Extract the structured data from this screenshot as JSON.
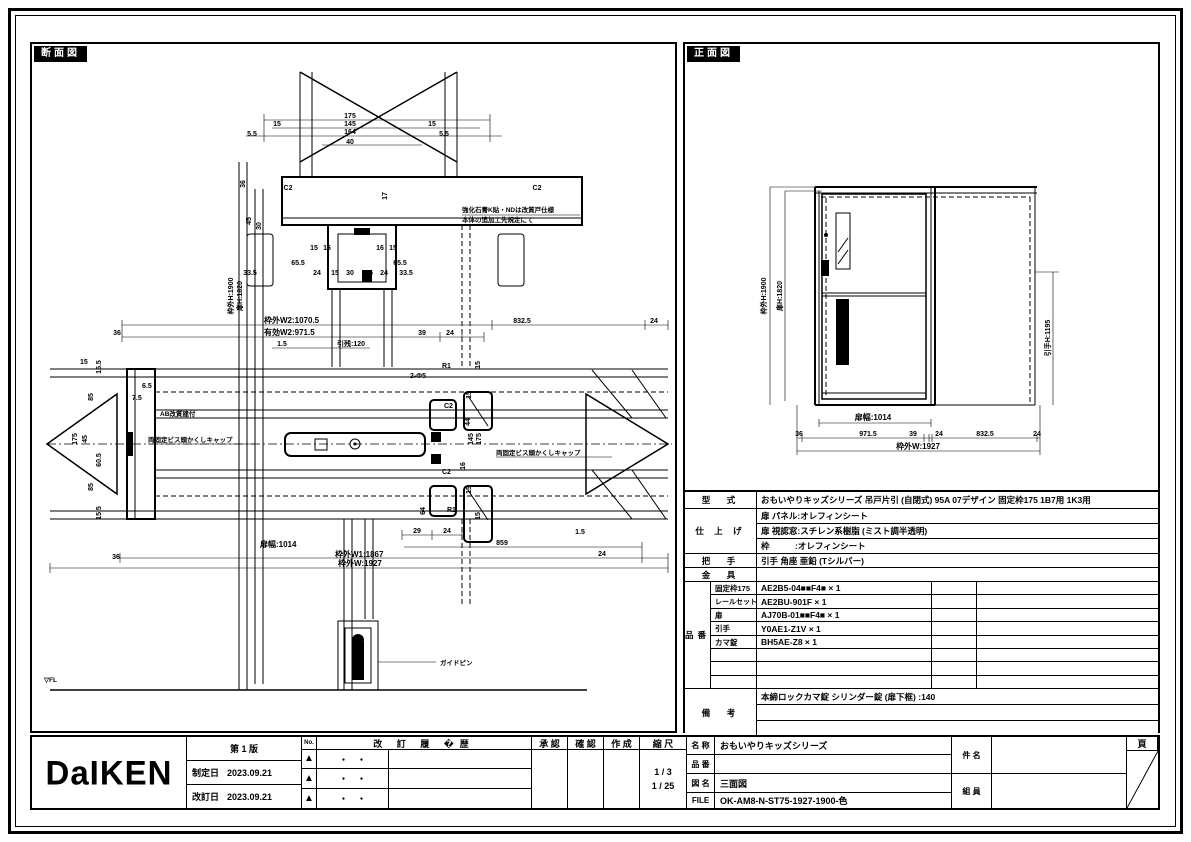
{
  "sheet": {
    "section_title": "断面図",
    "front_title": "正面図"
  },
  "sv": {
    "d": [
      "175",
      "15",
      "145",
      "15",
      "164",
      "5.5",
      "5.5",
      "40",
      "C2",
      "C2",
      "17",
      "36",
      "45",
      "30",
      "15",
      "16",
      "16",
      "15",
      "65.5",
      "65.5",
      "33.5",
      "24",
      "15",
      "30",
      "15",
      "24",
      "33.5",
      "枠外H:1900",
      "扉H:1820",
      "36",
      "枠外W2:1070.5",
      "有効W2:971.5",
      "1.5",
      "引残:120",
      "39",
      "24",
      "832.5",
      "24",
      "2-Φ5",
      "R1",
      "C2",
      "C2",
      "R1",
      "15",
      "15",
      "44",
      "145",
      "175",
      "16",
      "15",
      "15",
      "64",
      "7.5",
      "6.5",
      "15",
      "175",
      "45",
      "85",
      "85",
      "15.5",
      "15.5",
      "60.5",
      "29",
      "24",
      "859",
      "1.5",
      "24",
      "扉幅:1014",
      "枠外W1:1867",
      "枠外W:1927",
      "36"
    ],
    "notes": {
      "n1a": "強化石膏K貼・NDは改質戸仕様",
      "n1b": "本体の追加工先規定にて",
      "n2": "AB改質建付",
      "n3": "両固定ビス頭かくしキャップ",
      "n4": "両固定ビス頭かくしキャップ",
      "n5": "ガイドピン",
      "n6": "▽FL"
    }
  },
  "fv": {
    "d": [
      "枠外H:1900",
      "扉H:1820",
      "引手H:1195",
      "扉幅:1014",
      "36",
      "971.5",
      "39",
      "24",
      "832.5",
      "24",
      "枠外W:1927"
    ]
  },
  "spec": {
    "model_label": "型　式",
    "model": "おもいやりキッズシリーズ 吊戸片引 (自閉式) 95A 07デザイン 固定枠175 1B7用 1K3用",
    "finish_label": "仕 上 げ",
    "finish_rows": [
      "扉 パネル:オレフィンシート",
      "扉 視認窓:スチレン系樹脂 (ミスト調半透明)",
      "枠　　　:オレフィンシート"
    ],
    "handle_label": "把　手",
    "handle": "引手 角座 亜鉛 (Tシルバー)",
    "hardware_label": "金　具",
    "hardware": "",
    "parts_label": "品番",
    "parts": [
      {
        "name": "固定枠175",
        "code": "AE2B5-04■■F4■ × 1"
      },
      {
        "name": "レールセット",
        "code": "AE2BU-901F × 1"
      },
      {
        "name": "扉",
        "code": "AJ70B-01■■F4■ × 1"
      },
      {
        "name": "引手",
        "code": "Y0AE1-Z1V × 1"
      },
      {
        "name": "カマ錠",
        "code": "BH5AE-Z8 × 1"
      },
      {
        "name": "",
        "code": ""
      },
      {
        "name": "",
        "code": ""
      },
      {
        "name": "",
        "code": ""
      }
    ],
    "remarks_label": "備　考",
    "remarks": "本締ロックカマ錠 シリンダー錠 (扉下框) :140"
  },
  "tb": {
    "logo": "DaIKEN",
    "edition": "第 1 版",
    "enact_label": "制定日",
    "enact_date": "2023.09.21",
    "revise_label": "改訂日",
    "revise_date": "2023.09.21",
    "no_label": "No.",
    "history_label": "改 訂 履 �歴",
    "history_rows": [
      "・　・",
      "・　・",
      "・　・"
    ],
    "rev_marks": [
      "▲",
      "▲",
      "▲"
    ],
    "approve_label": "承 認",
    "check_label": "確 認",
    "create_label": "作 成",
    "scale_label": "縮 尺",
    "scale1": "1 / 3",
    "scale2": "1 / 25",
    "name_label": "名 称",
    "name_value": "おもいやりキッズシリーズ",
    "pn_label": "品 番",
    "pn_value": "",
    "dwg_label": "図 名",
    "dwg_value": "三面図",
    "file_label": "FILE",
    "file_value": "OK-AM8-N-ST75-1927-1900-色",
    "subject_label": "件 名",
    "member_label": "組 員",
    "page_label": "頁"
  }
}
